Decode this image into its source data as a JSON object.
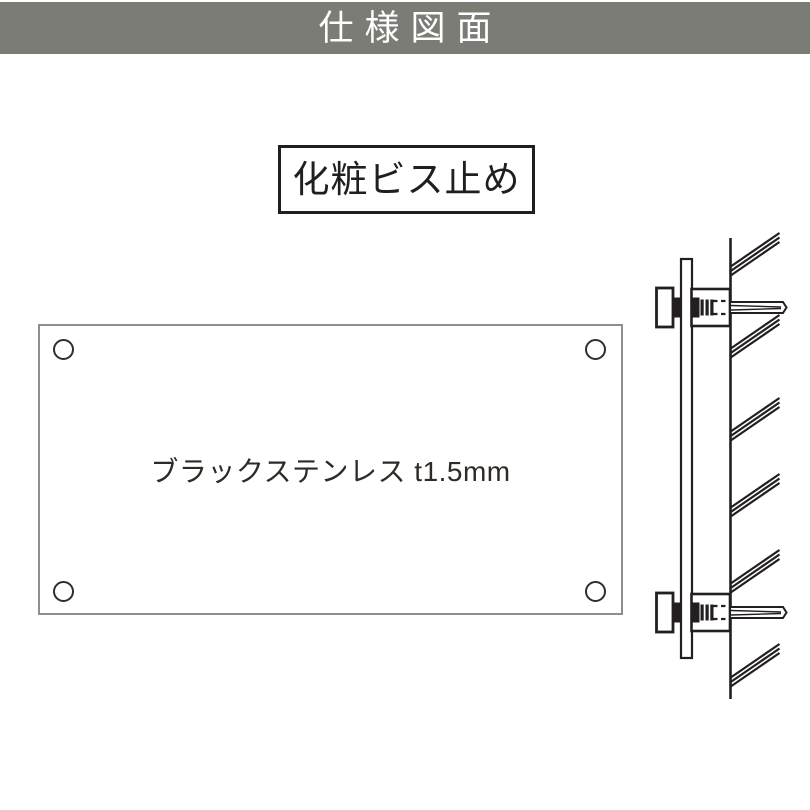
{
  "page": {
    "background": "#ffffff",
    "kind": "product-specification-drawing"
  },
  "header": {
    "title": "仕様図面",
    "bg_color": "#7a7c75",
    "text_color": "#ffffff"
  },
  "method_label": {
    "text": "化粧ビス止め",
    "border_color": "#1f1f1f"
  },
  "plate": {
    "material_label": "ブラックステンレス t1.5mm",
    "border_color": "#8e8e8e",
    "hole_count": 4
  },
  "side_view": {
    "description_name": "wall-mount-cross-section",
    "screw_count": 2,
    "hatch_group_count": 6,
    "line_color": "#231f20"
  }
}
